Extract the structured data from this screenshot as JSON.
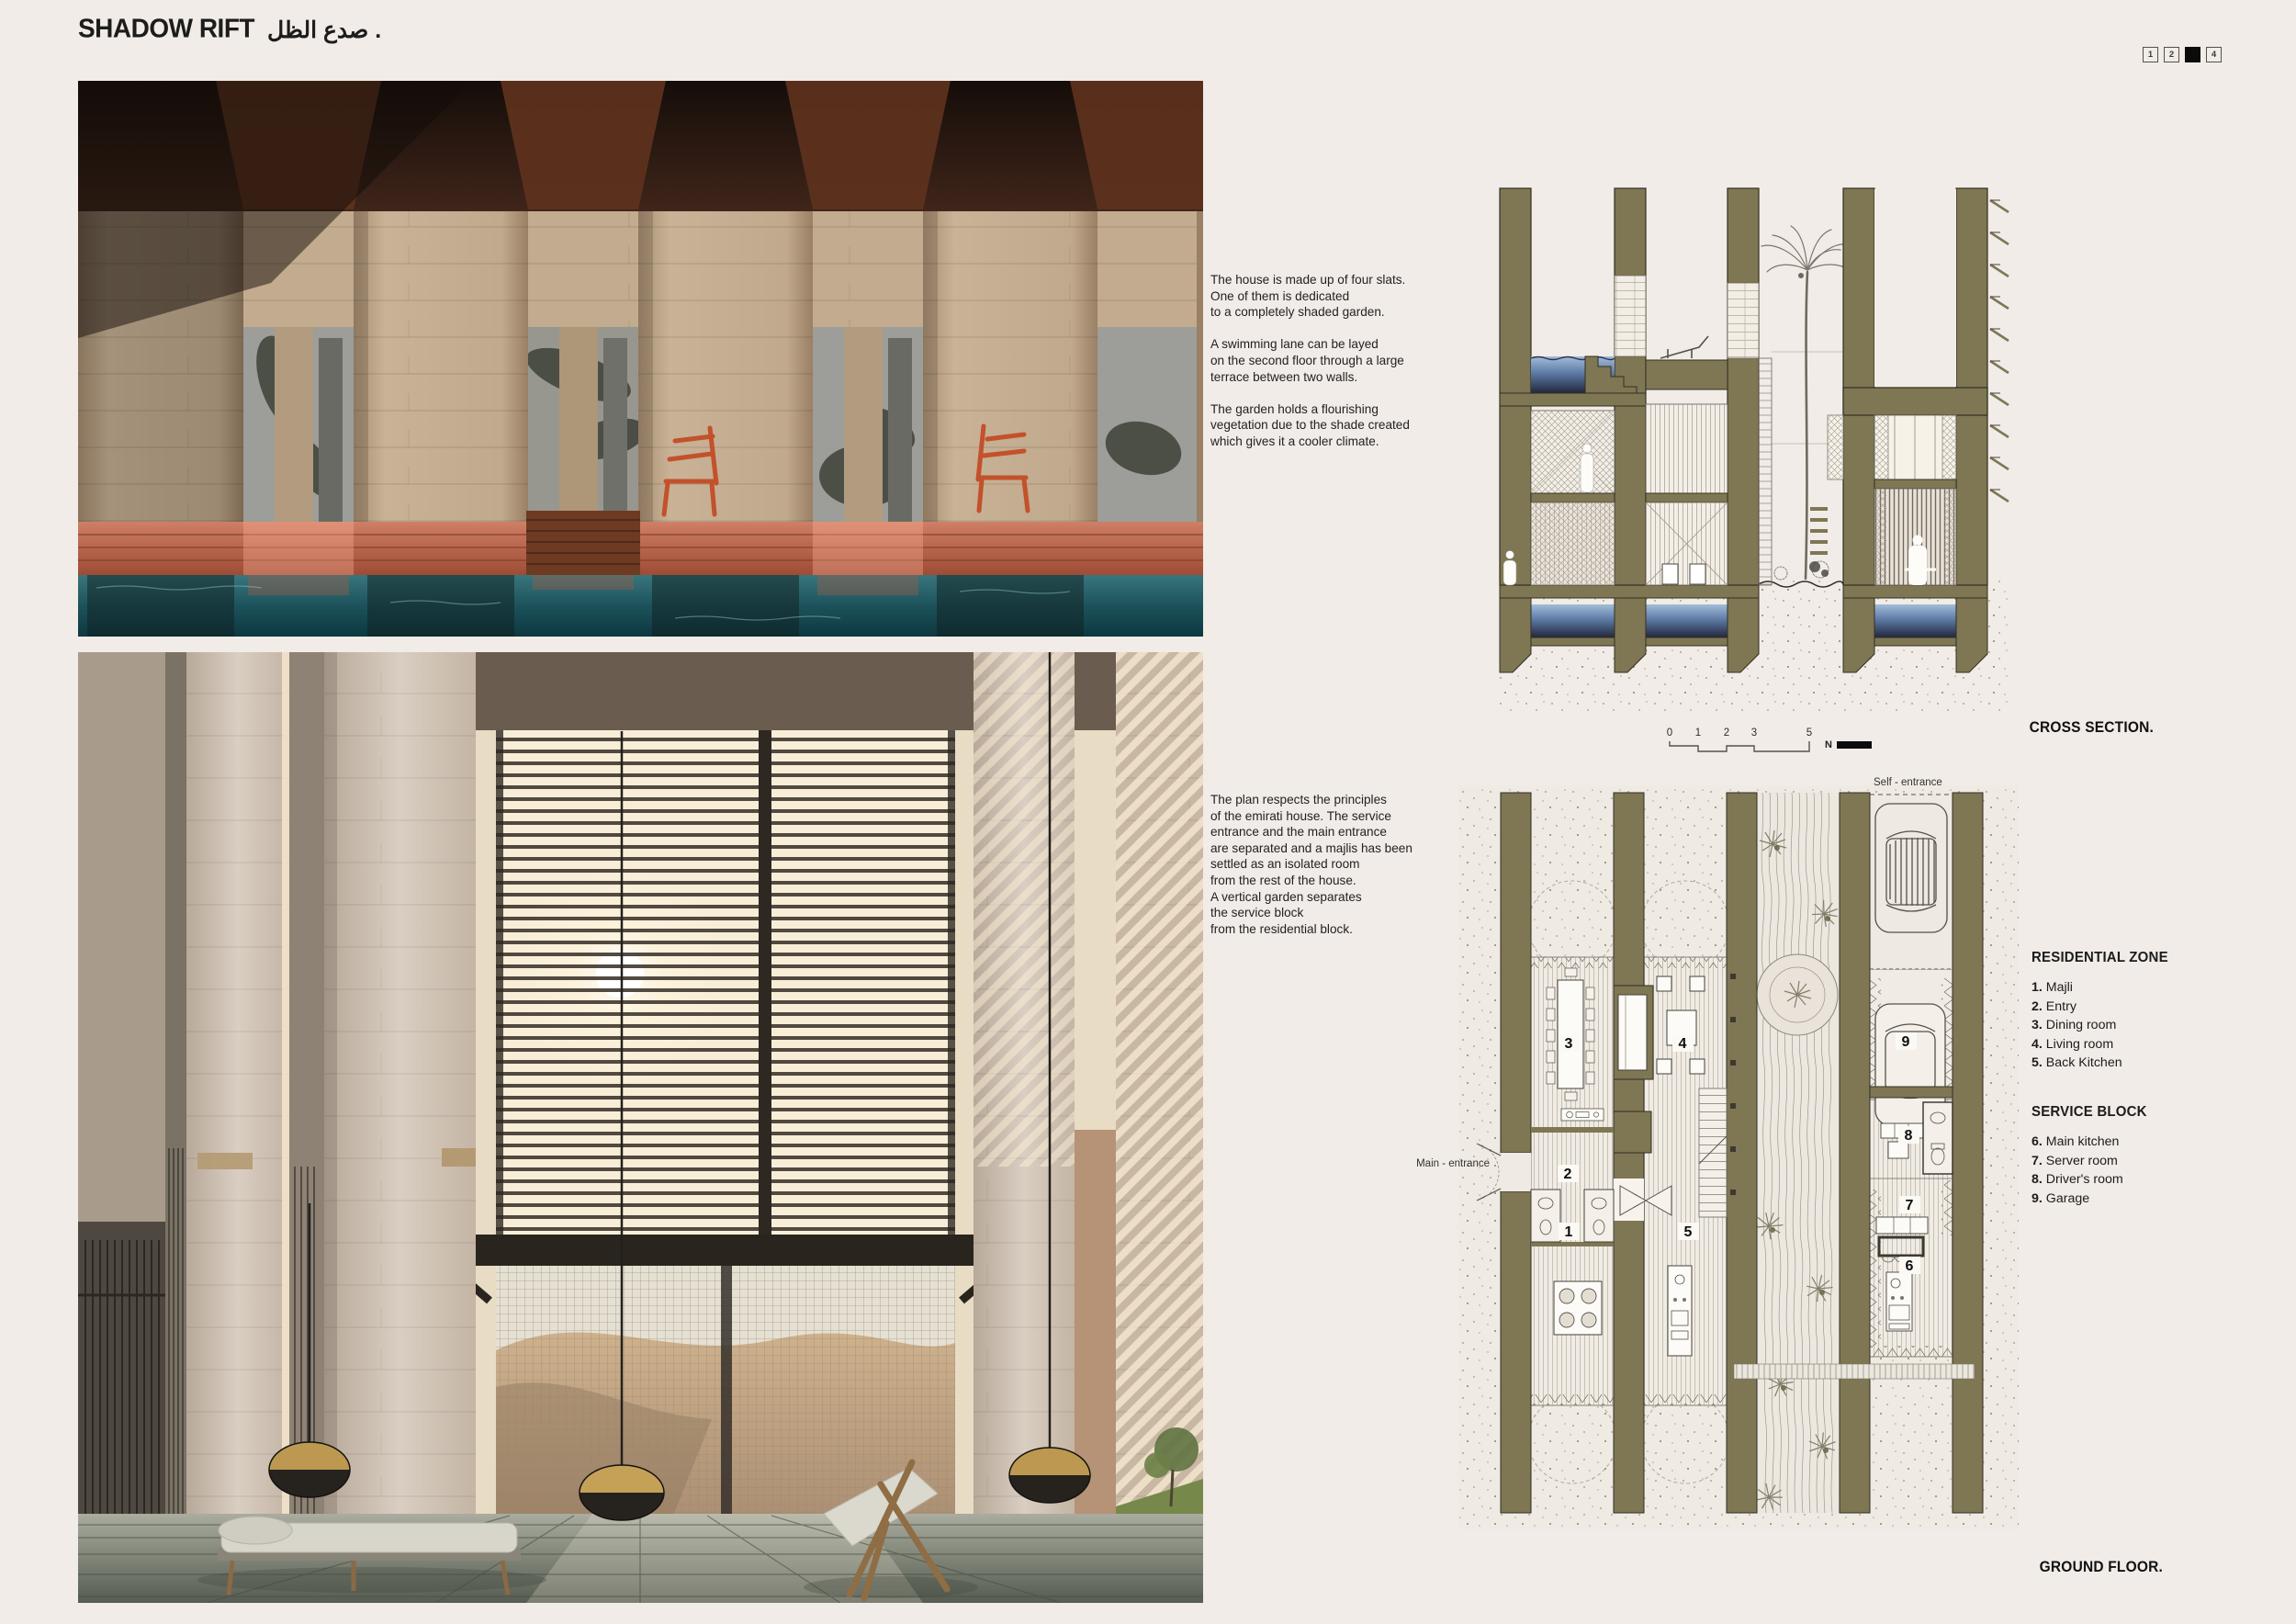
{
  "header": {
    "title_en": "SHADOW RIFT",
    "title_ar": "صدع الظل .",
    "pages": [
      "1",
      "2",
      "",
      "4"
    ],
    "active_page_index": 2
  },
  "texts": {
    "concept": "The house is made up of four slats.\nOne of them is dedicated\nto a completely shaded garden.\n\nA swimming lane can be layed\non the second floor through a large\nterrace between two walls.\n\nThe garden holds a flourishing\nvegetation due to the shade created\nwhich gives it a cooler climate.",
    "plan": "The plan respects the principles\nof the emirati house. The service\nentrance and the main entrance\nare separated and a majlis has been\nsettled as an isolated room\nfrom the rest of the house.\nA vertical garden separates\nthe service block\nfrom the residential block."
  },
  "drawings": {
    "cross_section_label": "CROSS SECTION.",
    "ground_floor_label": "GROUND FLOOR.",
    "self_entrance_label": "Self - entrance",
    "main_entrance_label": "Main - entrance",
    "scale": {
      "ticks": [
        "0",
        "1",
        "2",
        "3",
        "5"
      ],
      "north": "N"
    },
    "room_numbers": [
      "1",
      "2",
      "3",
      "4",
      "5",
      "6",
      "7",
      "8",
      "9"
    ]
  },
  "legend": {
    "residential": {
      "title": "RESIDENTIAL ZONE",
      "items": [
        {
          "num": "1.",
          "label": "Majli"
        },
        {
          "num": "2.",
          "label": "Entry"
        },
        {
          "num": "3.",
          "label": "Dining room"
        },
        {
          "num": "4.",
          "label": "Living room"
        },
        {
          "num": "5.",
          "label": "Back Kitchen"
        }
      ]
    },
    "service": {
      "title": "SERVICE BLOCK",
      "items": [
        {
          "num": "6.",
          "label": "Main kitchen"
        },
        {
          "num": "7.",
          "label": "Server room"
        },
        {
          "num": "8.",
          "label": "Driver's room"
        },
        {
          "num": "9.",
          "label": "Garage"
        }
      ]
    }
  },
  "colors": {
    "background": "#f1ece7",
    "wall_olive": "#7f7654",
    "water_blue": "#5d7ba6",
    "accent_orange": "#c3512b",
    "pool_teal": "#2f6f77"
  }
}
